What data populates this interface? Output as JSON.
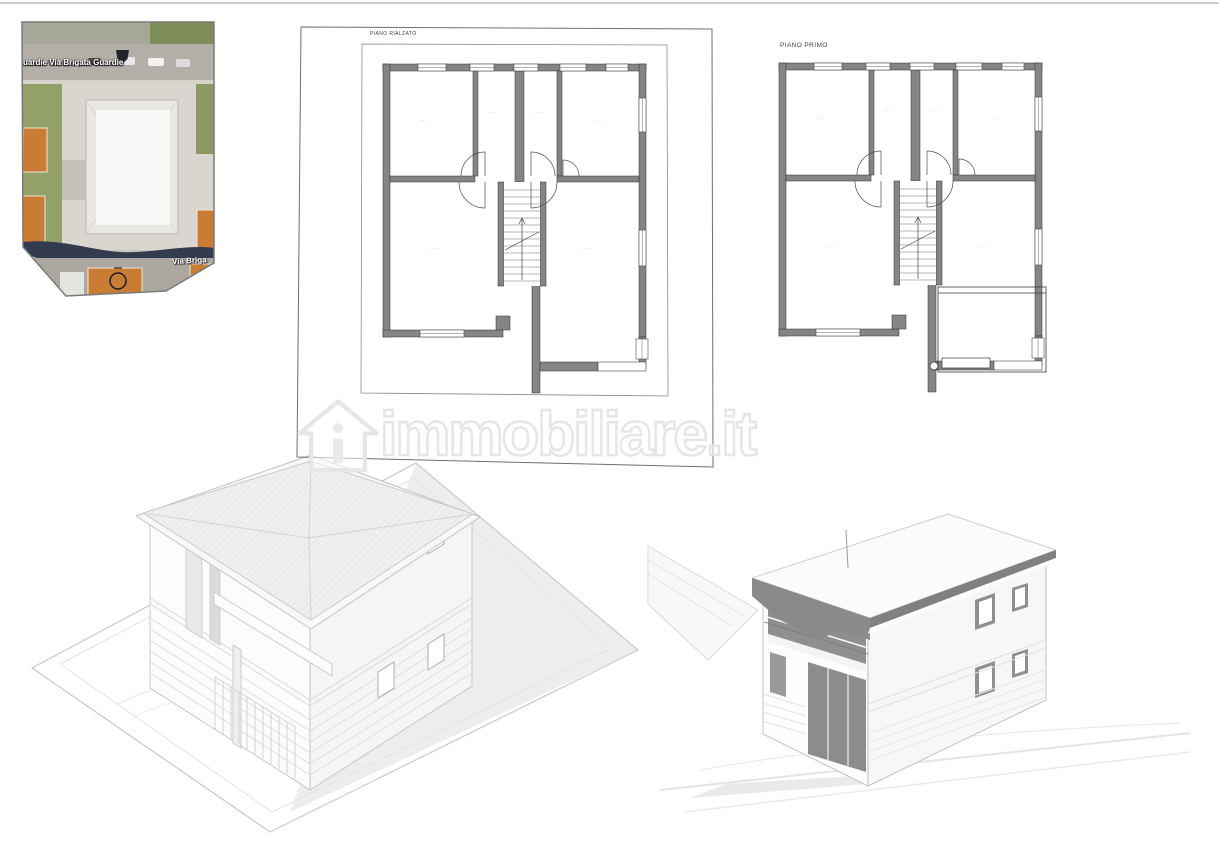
{
  "map": {
    "street_top": "uardie Via Brigata Guardie",
    "street_bottom": "Via Briga",
    "marker_icon": "circle-marker",
    "shield_icon": "road-shield-icon",
    "colors": {
      "road": "#b3afa8",
      "vegetation": "#93a06a",
      "roof_orange": "#c87c34",
      "hedge_shadow": "#333b4f",
      "courtyard": "#d9d6d0",
      "building": "#f8f7f5"
    }
  },
  "plans": {
    "center": {
      "title": "PIANO RIALZATO",
      "rooms": [
        "···",
        "···",
        "···",
        "···",
        "···",
        "···"
      ]
    },
    "right": {
      "title": "PIANO PRIMO",
      "rooms": [
        "···",
        "···",
        "···",
        "···",
        "···",
        "···"
      ]
    },
    "wall_color": "#858585",
    "line_color": "#2e2e2e"
  },
  "watermark": {
    "text": "immobiliare.it",
    "logo_icon": "house-icon",
    "color": "#e6e6e6"
  },
  "renders": {
    "left_style": "axonometric white model",
    "right_style": "perspective shaded model"
  }
}
